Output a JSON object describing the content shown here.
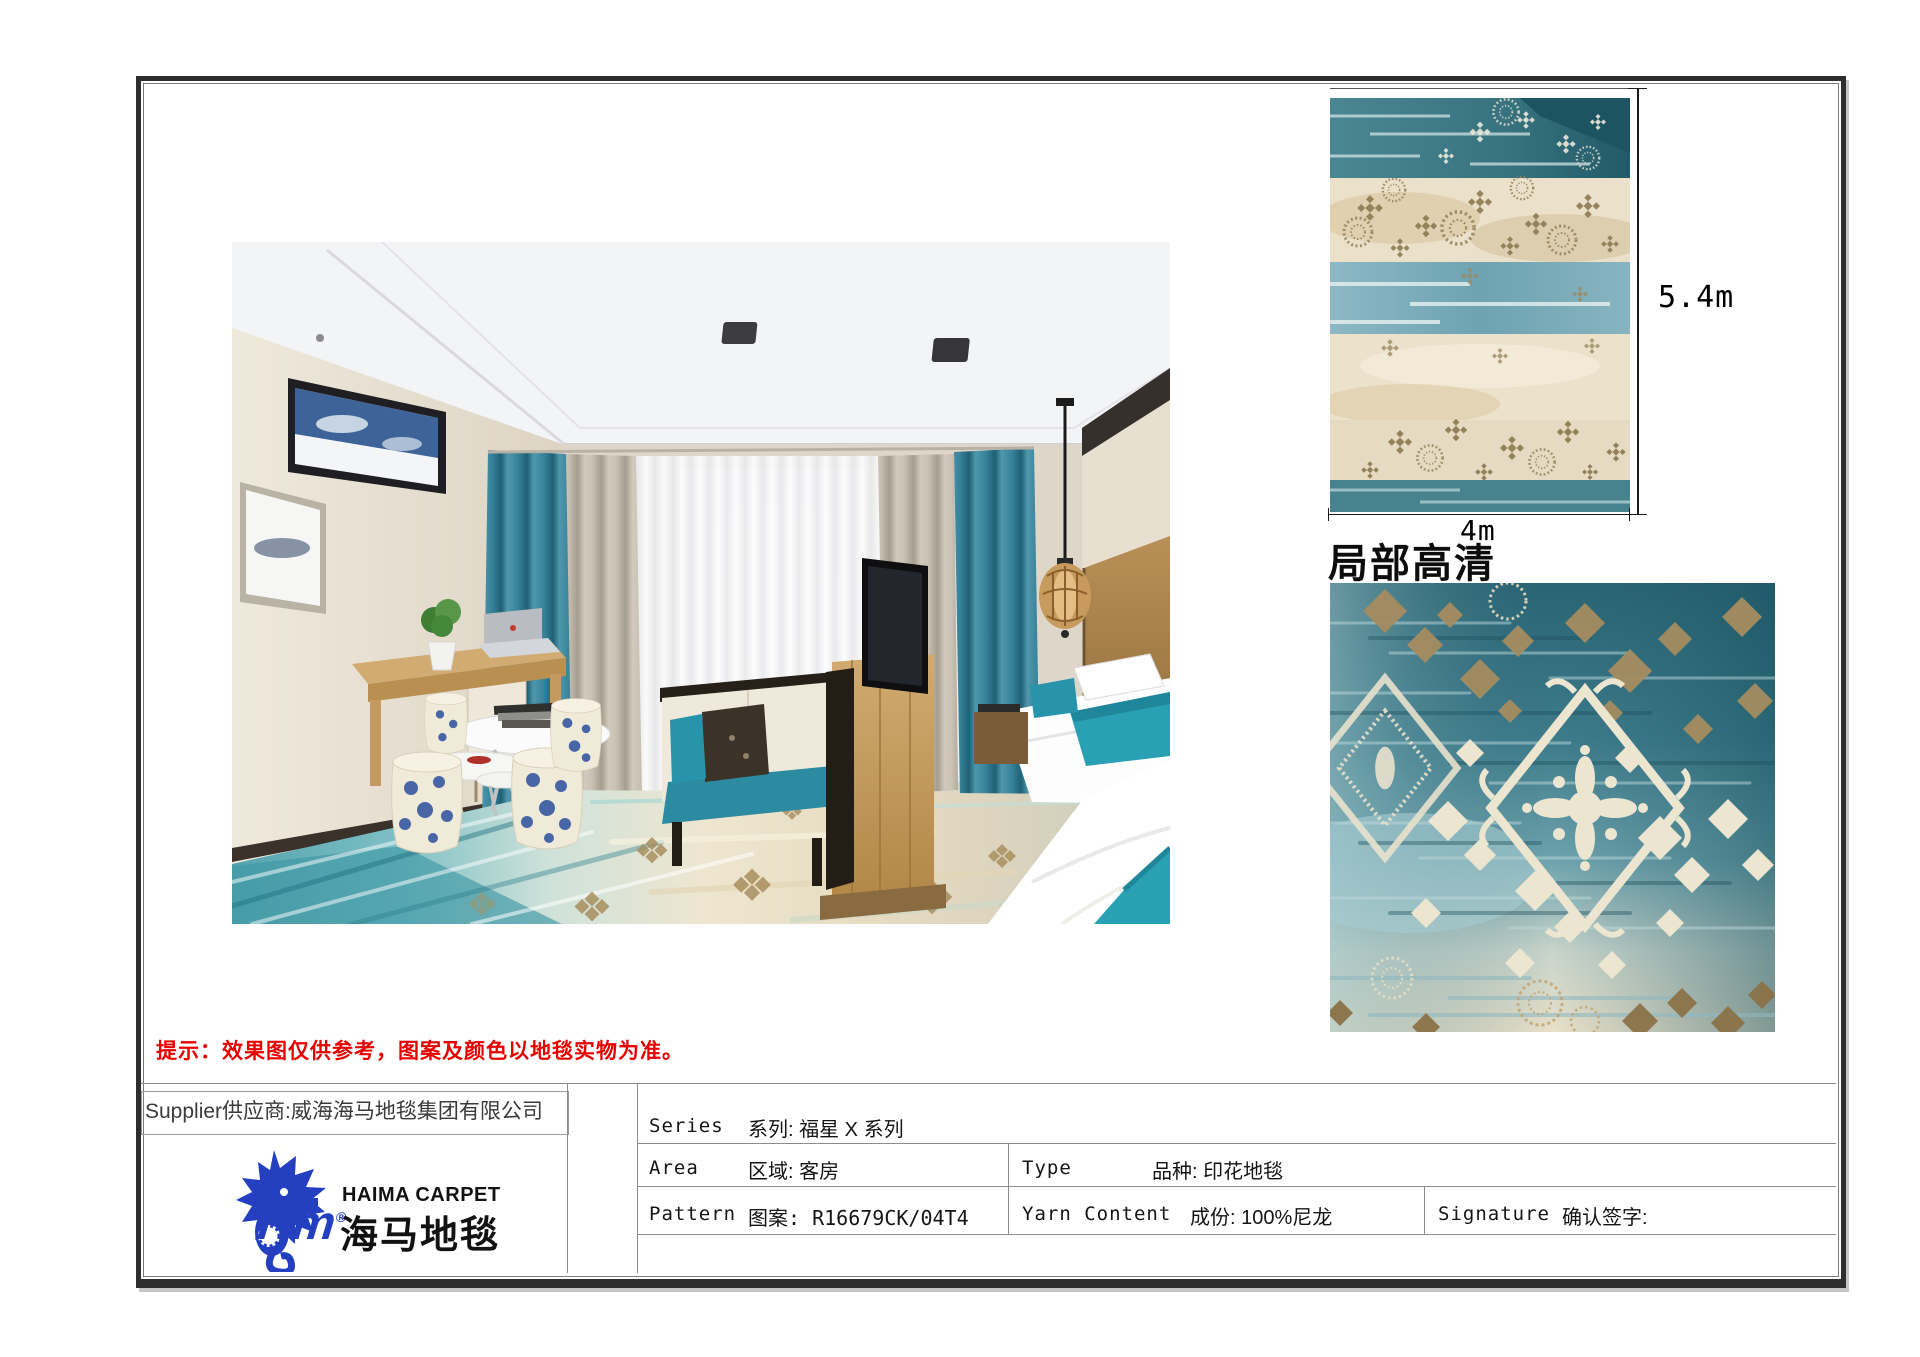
{
  "sheet": {
    "notice": "提示：效果图仅供参考，图案及颜色以地毯实物为准。",
    "detail_section_title": "局部高清",
    "rug_height_label": "5.4m",
    "rug_width_label": "4m"
  },
  "supplier": {
    "line": "Supplier供应商:威海海马地毯集团有限公司"
  },
  "brand": {
    "monogram": "Hm",
    "registered": "®",
    "name_en": "HAIMA CARPET",
    "name_zh": "海马地毯"
  },
  "spec_table": {
    "series_label": "Series",
    "series_value": "系列: 福星 X 系列",
    "area_label": "Area",
    "area_value": "区域: 客房",
    "type_label": "Type",
    "type_value": "品种: 印花地毯",
    "pattern_label": "Pattern",
    "pattern_value": "图案: R16679CK/04T4",
    "yarn_label": "Yarn Content",
    "yarn_value": "成份: 100%尼龙",
    "signature_label": "Signature",
    "signature_value": "确认签字:"
  },
  "palette": {
    "brand_blue": "#2440c0",
    "notice_red": "#e60000",
    "carpet_teal": "#3f8293",
    "carpet_deep_teal": "#2a6170",
    "carpet_cream": "#ece3cd",
    "carpet_tan": "#b59a6b",
    "carpet_brown": "#8b7348"
  }
}
